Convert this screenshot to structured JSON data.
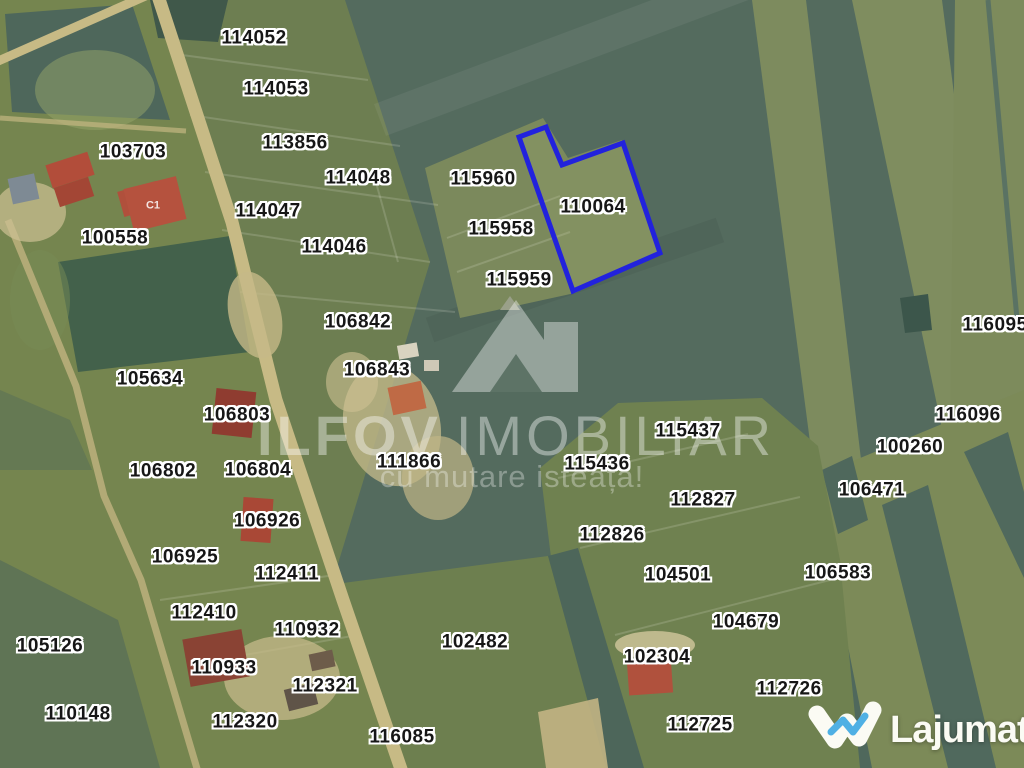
{
  "map": {
    "parcels": [
      {
        "id": "114052",
        "x": 254,
        "y": 38
      },
      {
        "id": "114053",
        "x": 276,
        "y": 89
      },
      {
        "id": "103703",
        "x": 133,
        "y": 152
      },
      {
        "id": "113856",
        "x": 295,
        "y": 143
      },
      {
        "id": "114048",
        "x": 358,
        "y": 178
      },
      {
        "id": "115960",
        "x": 483,
        "y": 179
      },
      {
        "id": "110064",
        "x": 593,
        "y": 207
      },
      {
        "id": "114047",
        "x": 268,
        "y": 211
      },
      {
        "id": "100558",
        "x": 115,
        "y": 238
      },
      {
        "id": "115958",
        "x": 501,
        "y": 229
      },
      {
        "id": "114046",
        "x": 334,
        "y": 247
      },
      {
        "id": "115959",
        "x": 519,
        "y": 280
      },
      {
        "id": "106842",
        "x": 358,
        "y": 322
      },
      {
        "id": "116095",
        "x": 995,
        "y": 325
      },
      {
        "id": "106843",
        "x": 377,
        "y": 370
      },
      {
        "id": "105634",
        "x": 150,
        "y": 379
      },
      {
        "id": "106803",
        "x": 237,
        "y": 415
      },
      {
        "id": "116096",
        "x": 968,
        "y": 415
      },
      {
        "id": "115437",
        "x": 688,
        "y": 431
      },
      {
        "id": "100260",
        "x": 910,
        "y": 447
      },
      {
        "id": "111866",
        "x": 409,
        "y": 462
      },
      {
        "id": "115436",
        "x": 597,
        "y": 464
      },
      {
        "id": "106802",
        "x": 163,
        "y": 471
      },
      {
        "id": "106804",
        "x": 258,
        "y": 470
      },
      {
        "id": "106471",
        "x": 872,
        "y": 490
      },
      {
        "id": "112827",
        "x": 703,
        "y": 500
      },
      {
        "id": "106926",
        "x": 267,
        "y": 521
      },
      {
        "id": "112826",
        "x": 612,
        "y": 535
      },
      {
        "id": "106925",
        "x": 185,
        "y": 557
      },
      {
        "id": "106583",
        "x": 838,
        "y": 573
      },
      {
        "id": "112411",
        "x": 287,
        "y": 574
      },
      {
        "id": "104501",
        "x": 678,
        "y": 575
      },
      {
        "id": "112410",
        "x": 204,
        "y": 613
      },
      {
        "id": "104679",
        "x": 746,
        "y": 622
      },
      {
        "id": "110932",
        "x": 307,
        "y": 630
      },
      {
        "id": "105126",
        "x": 50,
        "y": 646
      },
      {
        "id": "102482",
        "x": 475,
        "y": 642
      },
      {
        "id": "102304",
        "x": 657,
        "y": 657
      },
      {
        "id": "110933",
        "x": 224,
        "y": 668
      },
      {
        "id": "112321",
        "x": 325,
        "y": 686
      },
      {
        "id": "112726",
        "x": 789,
        "y": 689
      },
      {
        "id": "110148",
        "x": 78,
        "y": 714
      },
      {
        "id": "112320",
        "x": 245,
        "y": 722
      },
      {
        "id": "112725",
        "x": 700,
        "y": 725
      },
      {
        "id": "116085",
        "x": 402,
        "y": 737
      },
      {
        "id": "C1",
        "x": 153,
        "y": 206,
        "small": true
      }
    ],
    "highlighted_parcel": {
      "id": "110064",
      "points": "519,137 546,127 562,165 623,143 660,253 573,291",
      "outline_color": "#2222dd"
    },
    "watermark": {
      "brand_word1": "ILFOV",
      "brand_word2": "IMOBILIAR",
      "tagline": "cu mutare isteață!"
    },
    "logo": {
      "text": "Lajumate",
      "tld": ".ro",
      "accent_color": "#55b4e8"
    }
  }
}
